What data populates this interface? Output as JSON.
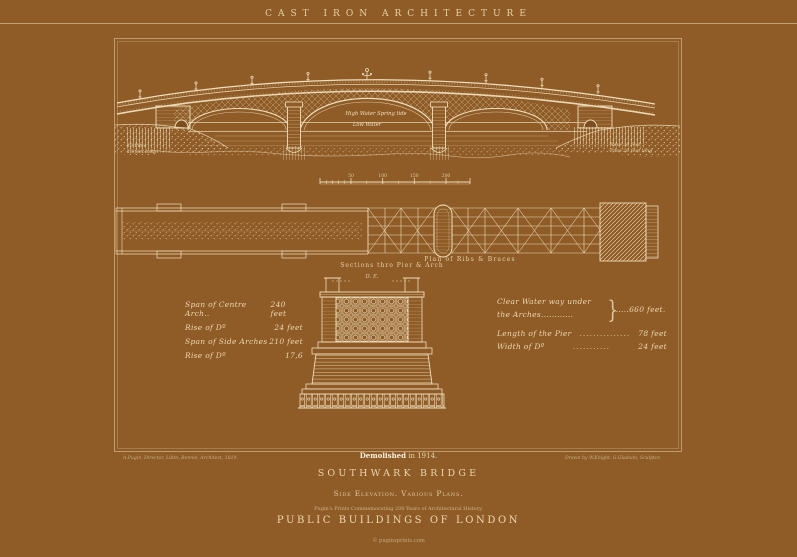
{
  "colors": {
    "background": "#8F5B26",
    "ink": "#EFDFBC",
    "ink_bright": "#FBF2DD",
    "ink_dim": "#D8C497"
  },
  "header": {
    "series_heading": "CAST IRON ARCHITECTURE"
  },
  "plate": {
    "elevation": {
      "high_water_label": "High Water Spring tide",
      "low_water_label": "Low Water",
      "left_pile_note": [
        "12 Piles",
        "18 feet long"
      ],
      "right_pile_note": [
        "Base 36 feet",
        "Piles 20 feet long"
      ]
    },
    "scale_bar": {
      "tick_labels": [
        "50",
        "100",
        "150",
        "200"
      ]
    },
    "plan": {
      "caption": "Plan of Ribs & Braces"
    },
    "section": {
      "caption": "Sections thro Pier & Arch",
      "reference_letters": "D. E."
    },
    "dimensions_left": [
      {
        "label": "Span of Centre Arch..",
        "value": "240 feet"
      },
      {
        "label": "Rise of Dº",
        "value": "24 feet"
      },
      {
        "label": "Span of Side Arches",
        "value": "210 feet"
      },
      {
        "label": "Rise of Dº",
        "value": "17,6"
      }
    ],
    "dimensions_right": {
      "clear_water_line1": "Clear Water way under",
      "clear_water_line2": "the Arches............",
      "brace": "}",
      "clear_water_value": "......660 feet.",
      "rows": [
        {
          "label": "Length of the Pier",
          "dots": "...............",
          "value": "78 feet"
        },
        {
          "label": "Width of Dº",
          "dots": "...........",
          "value": "24 feet"
        }
      ]
    }
  },
  "footer": {
    "demolished_emphasis": "Demolished",
    "demolished_rest": " in 1914.",
    "credit_left": "A.Pugin, Director, Libtn, Rennie, Architect, 1819.",
    "credit_right": "Drawn by W.Knight. G.Gladwin, Sculptor.",
    "plate_title": "SOUTHWARK BRIDGE",
    "plate_subtitle": "Side Elevation. Various Plans.",
    "series_note": "Pugin's Prints Commemorating 200 Years of Architectural History.",
    "series_title": "PUBLIC BUILDINGS OF LONDON",
    "watermark": "© puginsprints.com"
  }
}
